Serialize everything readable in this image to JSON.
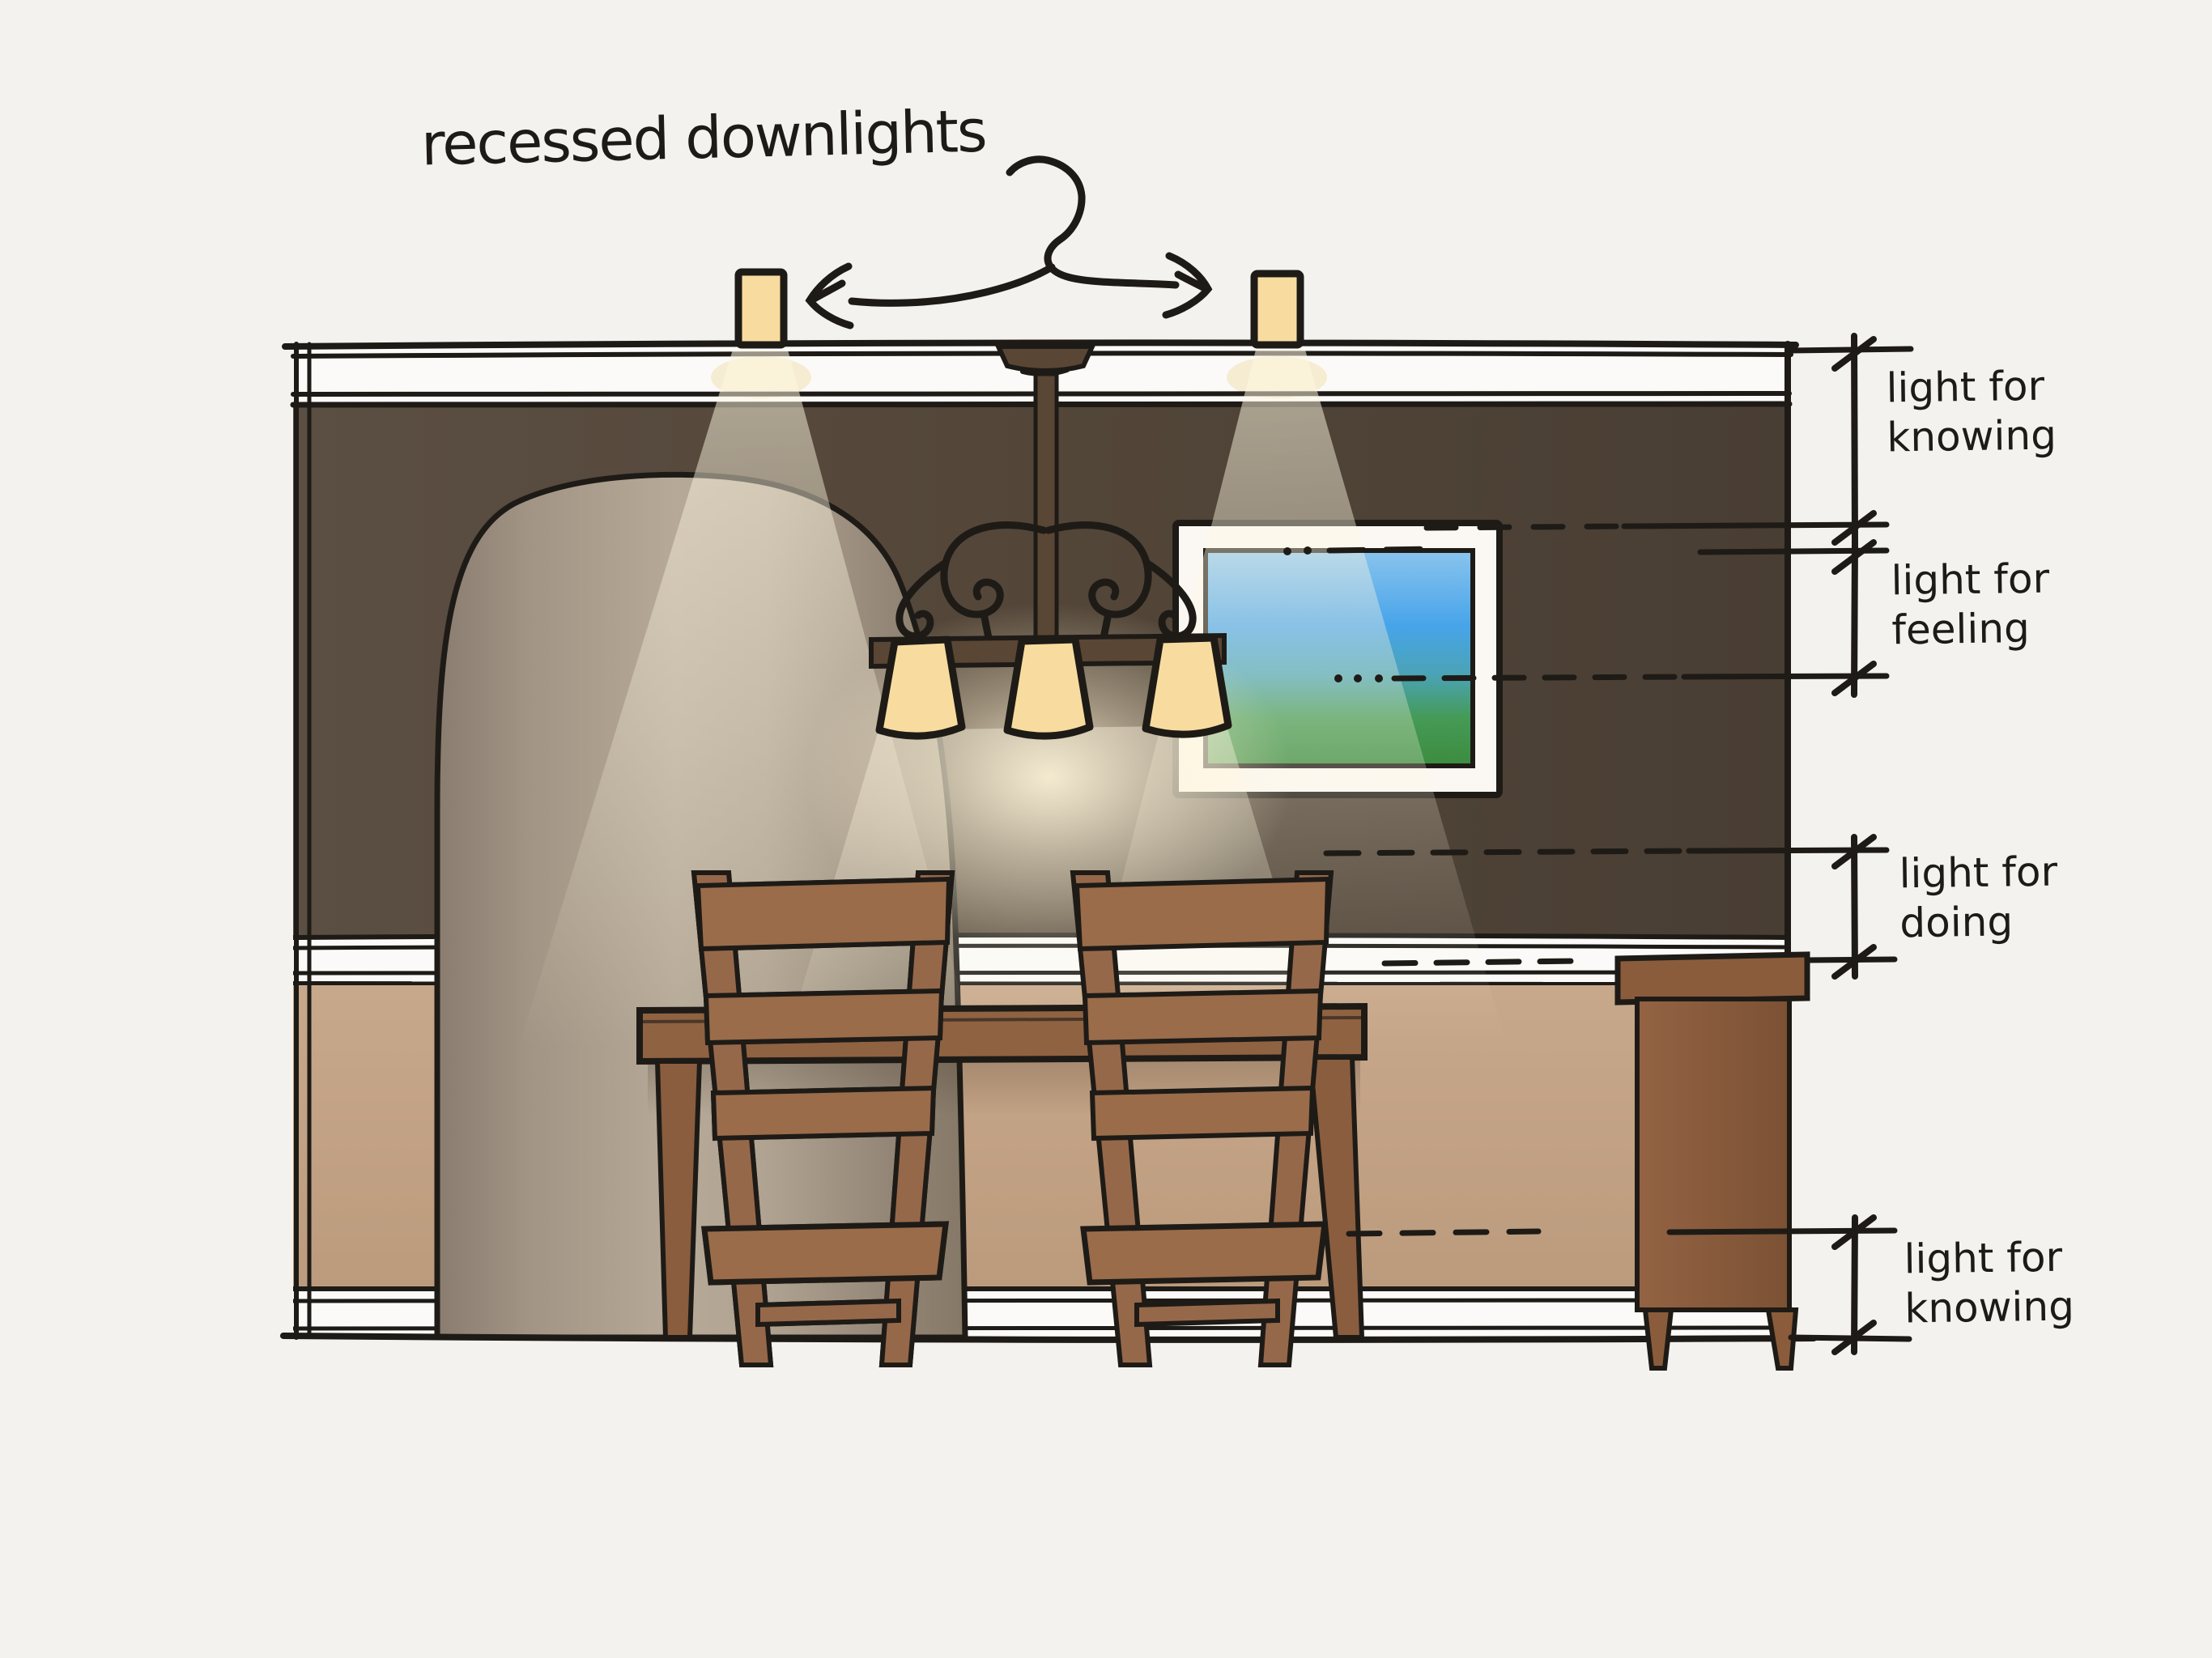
{
  "title": "recessed downlights",
  "annotations": [
    {
      "line1": "light for",
      "line2": "knowing"
    },
    {
      "line1": "light for",
      "line2": "feeling"
    },
    {
      "line1": "light for",
      "line2": "doing"
    },
    {
      "line1": "light for",
      "line2": "knowing"
    }
  ],
  "palette": {
    "paper": "#f4f2ef",
    "ink": "#1e1b17",
    "ceiling_white": "#fbfaf8",
    "upper_wall_brown": "#52463c",
    "arch_interior_taupe": "#a89a8b",
    "wainscot_tan": "#c3a285",
    "wood_brown": "#96684a",
    "sideboard_brown": "#8a5c3c",
    "chandelier_metal": "#5a4634",
    "lampshade_yellow": "#f8dc9f",
    "beam_glow": "#fff7e1",
    "picture_sky_blue": "#47a4e9",
    "picture_grass_green": "#3c8c40",
    "picture_frame_white": "#fbf8f3"
  }
}
